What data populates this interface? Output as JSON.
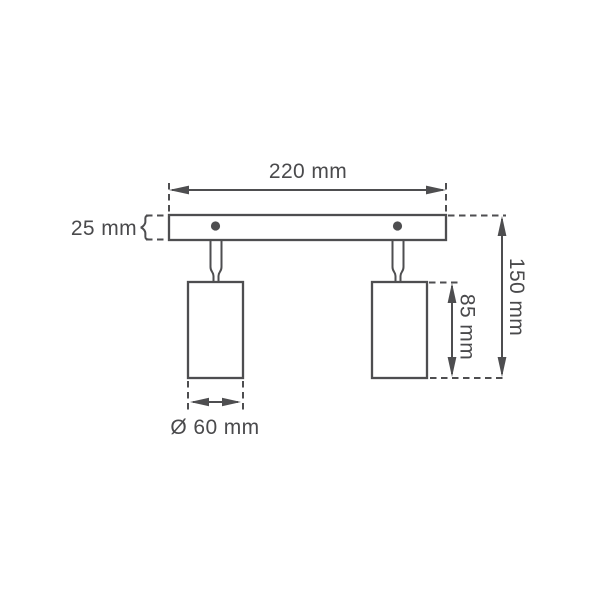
{
  "diagram": {
    "kind": "dimension-drawing",
    "subject": "two-spot ceiling light bar",
    "background_color": "#ffffff",
    "line_color": "#4e4e50",
    "text_color": "#4a4a4c",
    "labels": {
      "width": "220 mm",
      "plate_height": "25 mm",
      "total_height": "150 mm",
      "spot_height": "85 mm",
      "spot_diameter": "Ø 60 mm"
    },
    "values_mm": {
      "width": 220,
      "plate_height": 25,
      "total_height": 150,
      "spot_height": 85,
      "spot_diameter": 60
    }
  }
}
